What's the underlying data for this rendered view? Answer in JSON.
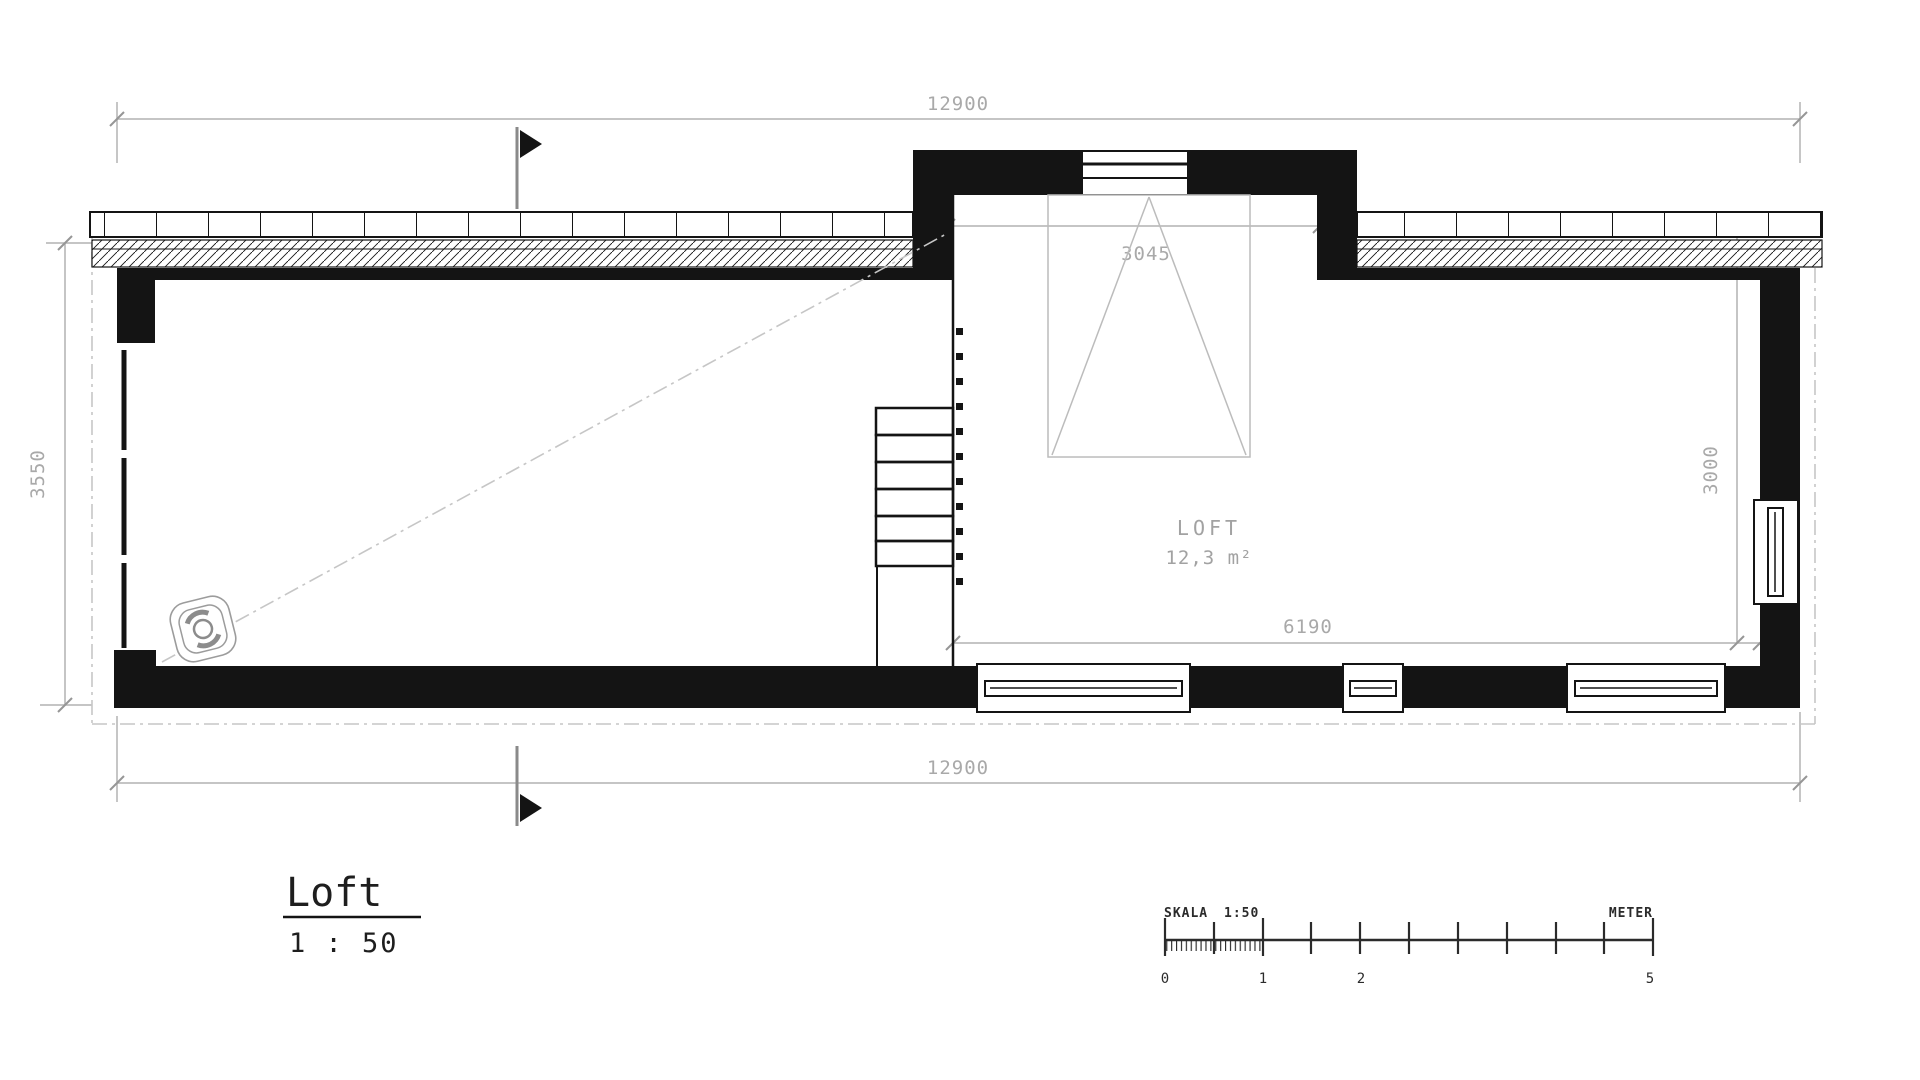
{
  "drawing": {
    "title": "Loft",
    "scale_label": "1 : 50",
    "room": {
      "name": "LOFT",
      "area": "12,3 m²"
    },
    "dimensions": {
      "overall_top": "12900",
      "overall_bottom": "12900",
      "left_depth": "3550",
      "right_depth": "3000",
      "dormer_width": "3045",
      "loft_width": "6190"
    },
    "scale_bar": {
      "skala": "SKALA",
      "ratio": "1:50",
      "unit": "METER",
      "tick_0": "0",
      "tick_1": "1",
      "tick_2": "2",
      "tick_5": "5"
    },
    "colors": {
      "ink": "#141414",
      "dimension_gray": "#b2b2b2",
      "label_gray": "#a2a2a2"
    }
  }
}
